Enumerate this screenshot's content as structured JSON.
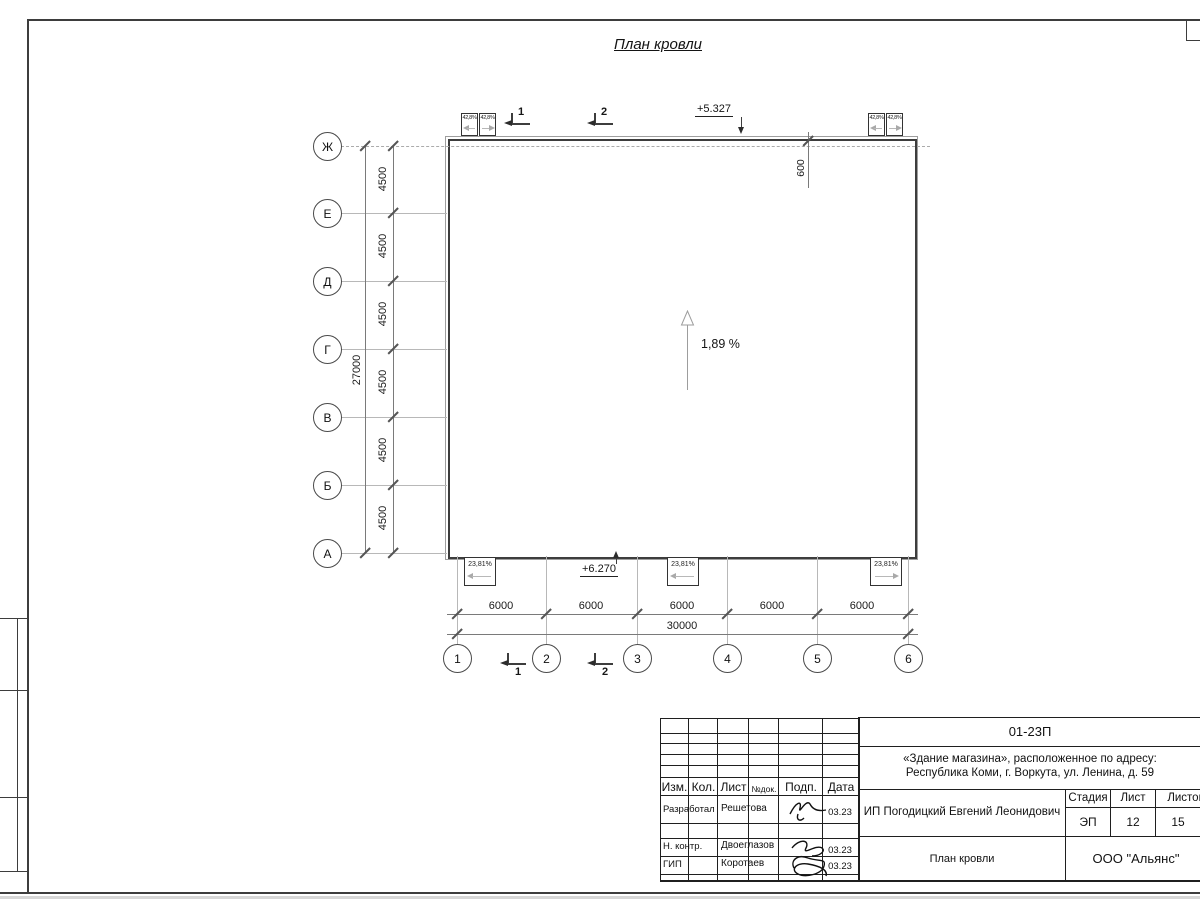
{
  "sheet": {
    "title": "План кровли"
  },
  "plan": {
    "slope_label": "1,89 %",
    "elevation_top": "+5.327",
    "elevation_bottom": "+6.270",
    "parapet_dim": "600",
    "drain_slope": "42,8%",
    "eave_slope": "23,81%"
  },
  "axes": {
    "left": [
      "Ж",
      "Е",
      "Д",
      "Г",
      "В",
      "Б",
      "А"
    ],
    "bottom": [
      "1",
      "2",
      "3",
      "4",
      "5",
      "6"
    ],
    "left_spacing": "4500",
    "left_total": "27000",
    "bottom_spacing": "6000",
    "bottom_total": "30000"
  },
  "sections": [
    "1",
    "2"
  ],
  "titleblock": {
    "doc_number": "01-23П",
    "object_line1": "«Здание магазина», расположенное по адресу:",
    "object_line2": "Республика Коми, г. Воркута, ул. Ленина, д. 59",
    "client": "ИП Погодицкий Евгений Леонидович",
    "sheet_name": "План кровли",
    "company": "ООО \"Альянс\"",
    "cols": {
      "izm": "Изм.",
      "kol": "Кол.",
      "list": "Лист",
      "doc": "№док.",
      "podp": "Подп.",
      "data": "Дата"
    },
    "stage_label": "Стадия",
    "sheet_label": "Лист",
    "sheets_label": "Листов",
    "stage": "ЭП",
    "sheet_no": "12",
    "sheets_total": "15",
    "rows": [
      {
        "role": "Разработал",
        "name": "Решетова",
        "date": "03.23"
      },
      {
        "role": "Н. контр.",
        "name": "Двоеглазов",
        "date": "03.23"
      },
      {
        "role": "ГИП",
        "name": "Коротаев",
        "date": "03.23"
      }
    ]
  }
}
